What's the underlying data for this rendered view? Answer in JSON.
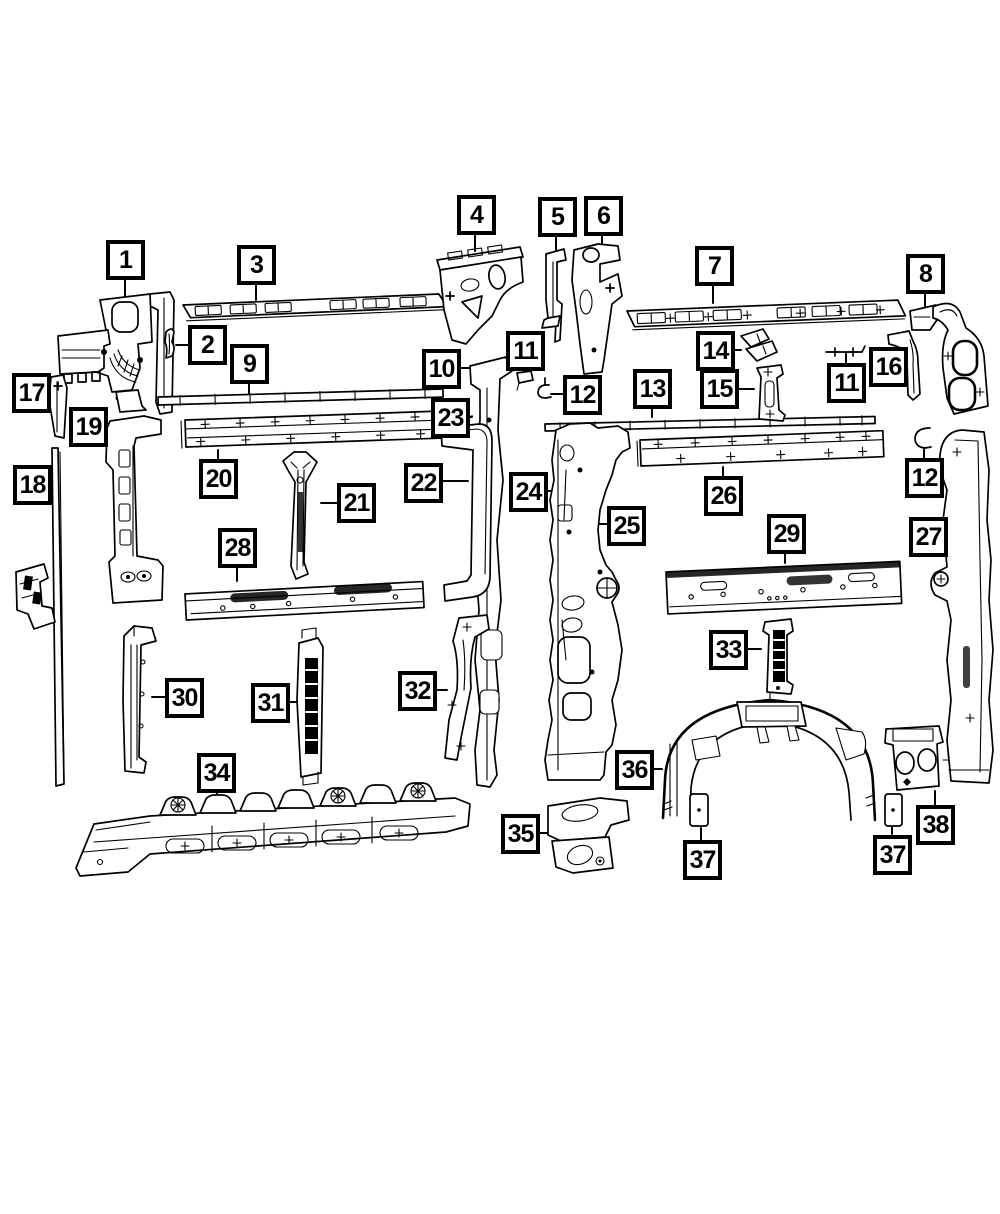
{
  "diagram": {
    "ink_color": "#000000",
    "paper_color": "#ffffff",
    "callouts": [
      {
        "label": "1"
      },
      {
        "label": "3"
      },
      {
        "label": "4"
      },
      {
        "label": "5"
      },
      {
        "label": "6"
      },
      {
        "label": "7"
      },
      {
        "label": "8"
      },
      {
        "label": "2"
      },
      {
        "label": "9"
      },
      {
        "label": "10"
      },
      {
        "label": "11"
      },
      {
        "label": "12"
      },
      {
        "label": "13"
      },
      {
        "label": "14"
      },
      {
        "label": "15"
      },
      {
        "label": "11"
      },
      {
        "label": "16"
      },
      {
        "label": "17"
      },
      {
        "label": "19"
      },
      {
        "label": "18"
      },
      {
        "label": "23"
      },
      {
        "label": "20"
      },
      {
        "label": "21"
      },
      {
        "label": "22"
      },
      {
        "label": "24"
      },
      {
        "label": "25"
      },
      {
        "label": "26"
      },
      {
        "label": "12"
      },
      {
        "label": "27"
      },
      {
        "label": "29"
      },
      {
        "label": "28"
      },
      {
        "label": "33"
      },
      {
        "label": "30"
      },
      {
        "label": "31"
      },
      {
        "label": "32"
      },
      {
        "label": "34"
      },
      {
        "label": "36"
      },
      {
        "label": "35"
      },
      {
        "label": "37"
      },
      {
        "label": "37"
      },
      {
        "label": "38"
      }
    ]
  }
}
